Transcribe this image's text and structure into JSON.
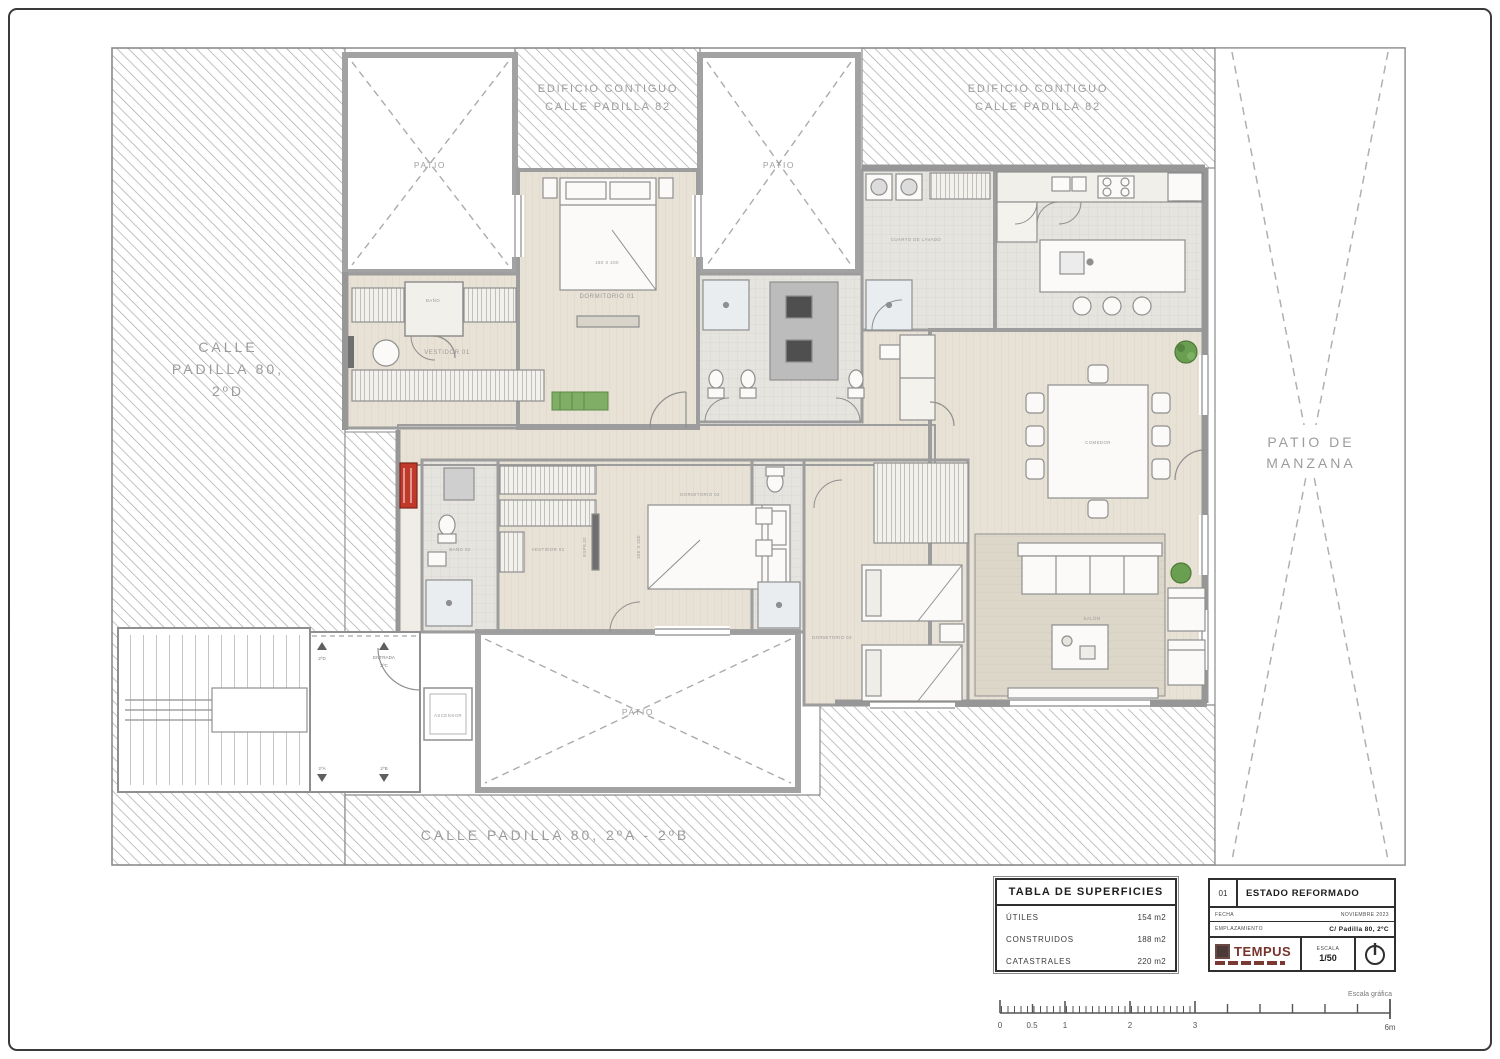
{
  "sheet": {
    "streets": {
      "left_line1": "CALLE",
      "left_line2": "PADILLA 80,",
      "left_line3": "2ºD",
      "bottom": "CALLE PADILLA 80, 2ºA - 2ºB"
    },
    "adjacent_building": {
      "line1": "EDIFICIO CONTIGUO",
      "line2": "CALLE PADILLA 82"
    },
    "patio_manzana_line1": "PATIO DE",
    "patio_manzana_line2": "MANZANA",
    "patio": "PATIO"
  },
  "rooms": {
    "dormitorio01": "DORMITORIO 01",
    "dormitorio01_bed": "180 X 200",
    "vestidor01": "VESTIDOR 01",
    "bano": "BAÑO",
    "cuarto_lavado": "CUARTO DE LAVADO",
    "comedor": "COMEDOR",
    "salon": "SALÓN",
    "dormitorio02": "DORMITORIO 02",
    "dormitorio02_bed": "160 X 200",
    "vestidor02": "VESTIDOR 02",
    "espejo": "ESPEJO",
    "bano02": "BAÑO 02",
    "dormitorio03": "DORMITORIO 03",
    "ascensor": "ASCENSOR"
  },
  "entrance": {
    "unit_left": "2ºD",
    "entrada_line1": "ENTRADA",
    "entrada_line2": "2ºC",
    "unit_bottom_left": "2ºA",
    "unit_bottom_right": "2ºB"
  },
  "surface_table": {
    "title": "TABLA DE SUPERFICIES",
    "rows": [
      {
        "label": "ÚTILES",
        "value": "154 m2"
      },
      {
        "label": "CONSTRUIDOS",
        "value": "188 m2"
      },
      {
        "label": "CATASTRALES",
        "value": "220 m2"
      }
    ]
  },
  "title_block": {
    "number": "01",
    "title": "ESTADO REFORMADO",
    "fecha_label": "FECHA",
    "fecha_value": "NOVIEMBRE 2023",
    "emplazamiento_label": "EMPLAZAMIENTO",
    "emplazamiento_value": "C/ Padilla 80, 2ºC",
    "logo": "TEMPUS",
    "escala_label": "ESCALA",
    "escala_value": "1/50"
  },
  "scale_bar": {
    "caption": "Escala gráfica",
    "ticks": [
      "0",
      "0.5",
      "1",
      "2",
      "3",
      "6m"
    ]
  },
  "colors": {
    "hatch": "#a8a8a8",
    "wall": "#9d9d9d",
    "floor": "#e8e1d5",
    "accent_red": "#c0392b",
    "plant_green": "#6a9e50"
  }
}
